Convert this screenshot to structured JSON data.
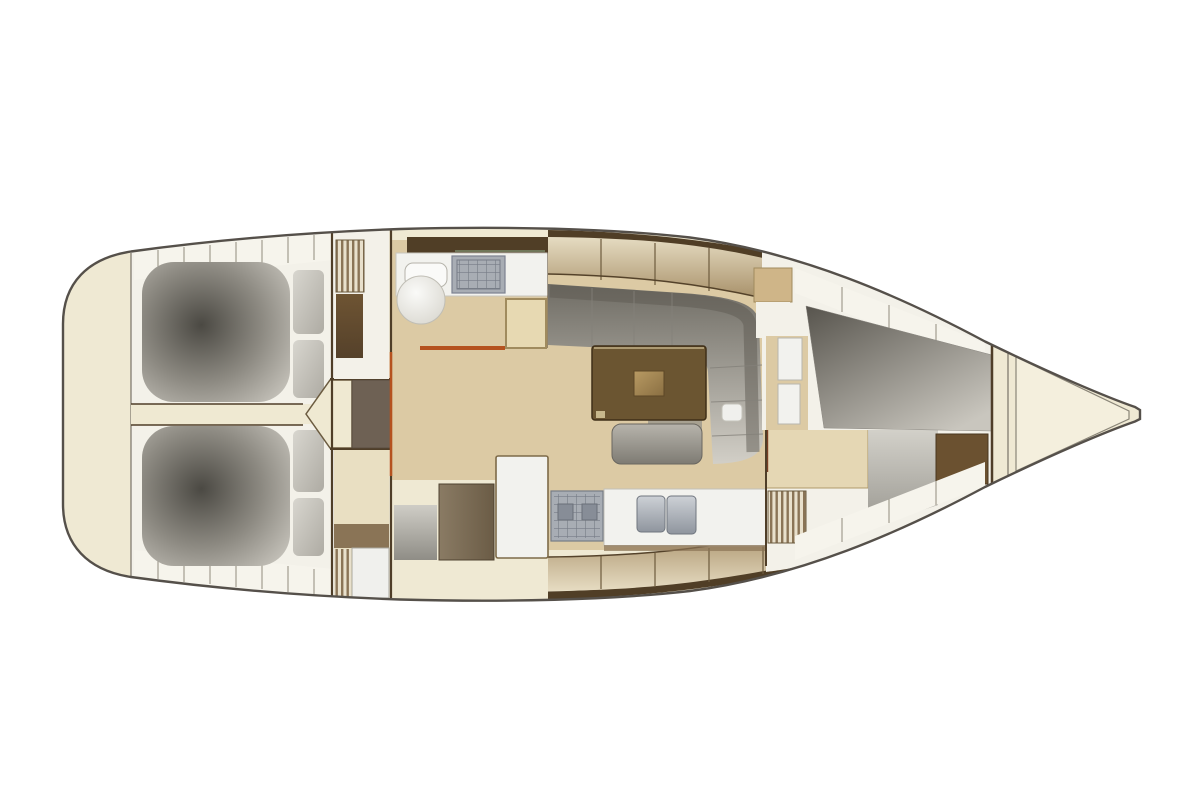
{
  "diagram": {
    "type": "boat-floorplan",
    "orientation": "bow-right"
  },
  "colors": {
    "background": "#ffffff",
    "hull_cream": "#efe9d3",
    "hull_outline": "#55504a",
    "deck_white": "#f3f1e9",
    "shelf_white": "#f6f4ec",
    "floor_tan": "#dccaa4",
    "floor_cream": "#e9dfc2",
    "corridor_cream": "#efe9d2",
    "berth_dark": "#4b4943",
    "berth_mid": "#8d8a82",
    "berth_light": "#c6c3bb",
    "pillow_light": "#d8d6cf",
    "pillow_dark": "#aeaba3",
    "sofa_dark": "#6f6c64",
    "sofa_light": "#d2cfc7",
    "sofa_back": "#5d5a52",
    "vberth_dark": "#57544d",
    "vberth_light": "#c9c6be",
    "table_brown": "#6b5531",
    "table_edge": "#3f2f18",
    "table_insert_light": "#b89a63",
    "table_insert_dark": "#8a6f42",
    "stool_light": "#b7b4ac",
    "stool_dark": "#7e7b73",
    "wood_dark": "#4f3e28",
    "band_brown": "#503e26",
    "locker_light": "#e6dcc2",
    "locker_dark": "#a8916a",
    "accent_orange": "#b5521f",
    "counter_white": "#f2f2ee",
    "steel_light": "#cdd1d6",
    "steel_dark": "#8f959e",
    "stove_body": "#a8adb4",
    "stove_frame": "#767c86",
    "burner": "#878d97",
    "chart_cream": "#e7d9b2",
    "chart_border": "#a08b5e",
    "trim_tan": "#cfb588",
    "cabinet_taupe_light": "#8a7b64",
    "cabinet_taupe_dark": "#6b5c46",
    "cabinet_brown_light": "#6e5433",
    "cabinet_brown_dark": "#55412a",
    "fwd_locker_brown": "#6b5130",
    "fridge_border": "#7d6a48",
    "stripe_dark": "#8a7456",
    "stripe_light": "#e8e0cc",
    "vanity_cream": "#e5d7b4",
    "vanity_border": "#b09a6a",
    "shower_light": "#cfcdc6",
    "shower_dark": "#8f8d86",
    "bow_wedge": "#f4efdd",
    "seat_white": "#fafaf8",
    "seat_shadow": "#d8d6ce",
    "step1": "#6e6154",
    "step2": "#978b7d",
    "step3": "#aaa093",
    "step4": "#c0b8ac",
    "door_white": "#f0f0ed",
    "green_line": "#7a8a6a"
  }
}
